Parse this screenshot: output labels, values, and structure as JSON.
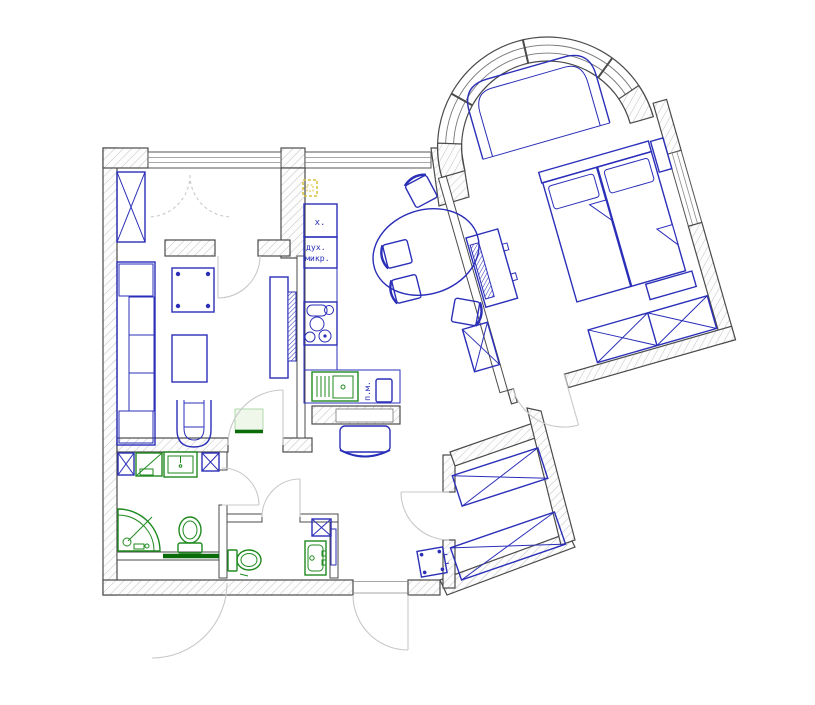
{
  "floorplan": {
    "labels": {
      "fridge": "х.",
      "oven": "дух.",
      "microwave": "микр.",
      "washing_machine": "п.м."
    },
    "colors": {
      "furniture_blue": "#2b2fb8",
      "plumbing_green": "#1f8a1f",
      "threshold_green": "#0b6b0b",
      "wall_outline": "#4b4b4b",
      "wall_hatch": "#c2c2c2",
      "door_arc_gray": "#c8c8c8",
      "electrical_yellow": "#d9c43e",
      "background": "#ffffff"
    }
  }
}
